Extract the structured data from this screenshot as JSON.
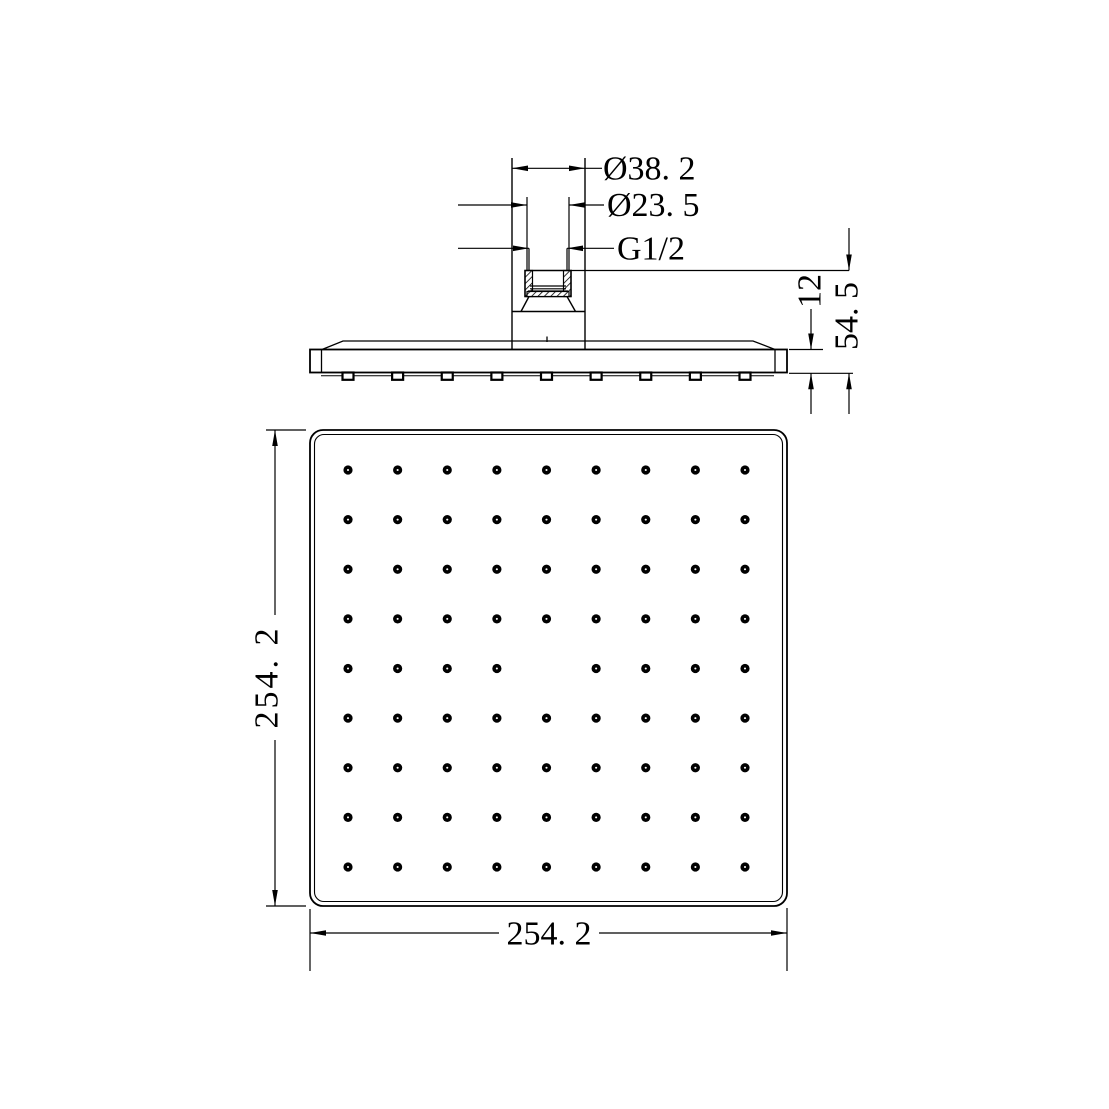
{
  "drawing": {
    "title": "Square shower head — dimensioned technical drawing",
    "views": [
      "side elevation",
      "bottom face view"
    ],
    "background": "#ffffff",
    "line_color": "#000000"
  },
  "labels": {
    "dia_outer": "Ø38. 2",
    "dia_thread": "Ø23. 5",
    "thread_size": "G1/2",
    "head_thickness": "12",
    "overall_height": "54. 5",
    "face_height": "254. 2",
    "face_width": "254. 2"
  },
  "dimensions_mm": {
    "inlet_outer_diameter": 38.2,
    "thread_collar_diameter": 23.5,
    "thread": "G1/2",
    "head_thickness": 12,
    "overall_height": 54.5,
    "face_width": 254.2,
    "face_height": 254.2
  },
  "nozzle_grid": {
    "rows": 9,
    "cols": 9,
    "center_missing": true,
    "visible_nozzles": 80
  }
}
